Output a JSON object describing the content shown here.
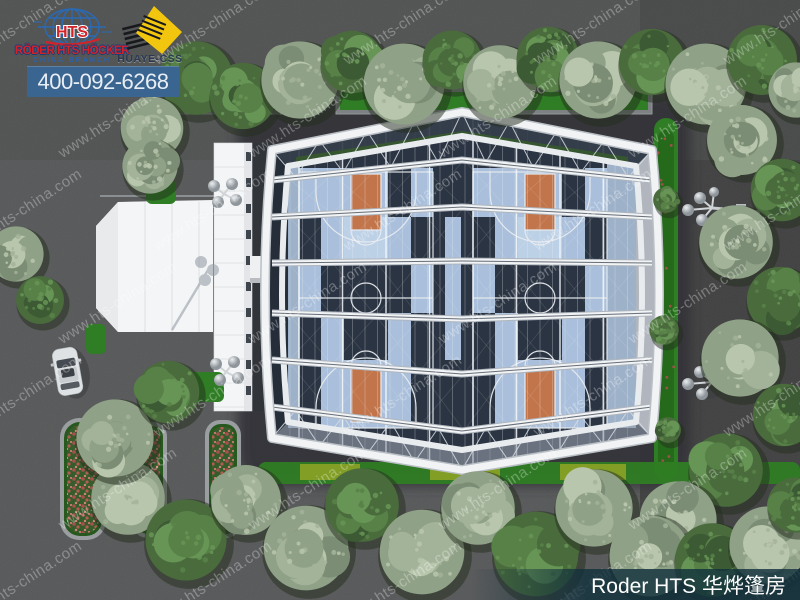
{
  "branding": {
    "hts_logo": {
      "acronym": "HTS",
      "company_line": "RÖDER HTS HÖCKER",
      "branch_line": "CHINA BRANCH"
    },
    "partner_logo": {
      "label": "HUAYE-CSS"
    },
    "phone": "400-092-6268"
  },
  "watermark": {
    "text": "www.hts-china.com"
  },
  "caption": {
    "text": "Roder HTS 华烨篷房"
  },
  "colors": {
    "ground": "#565758",
    "tent-navy": "#2b3442",
    "court-blue": "#a9bfdb",
    "court-blue-soft": "#9db1c9",
    "key-orange": "#c2754a",
    "frame-white": "#f1f3f5",
    "hedge-green": "#2f7d24",
    "hedge-yellow": "#97a824",
    "flower-red": "#a8504f",
    "phone-bar": "#3a6590",
    "logo-red": "#d2232b",
    "logo-blue": "#2a6ab5",
    "huaye-yellow": "#f2c50f",
    "caption-bg": "#10303c",
    "white-tent": "#f4f5f6"
  }
}
